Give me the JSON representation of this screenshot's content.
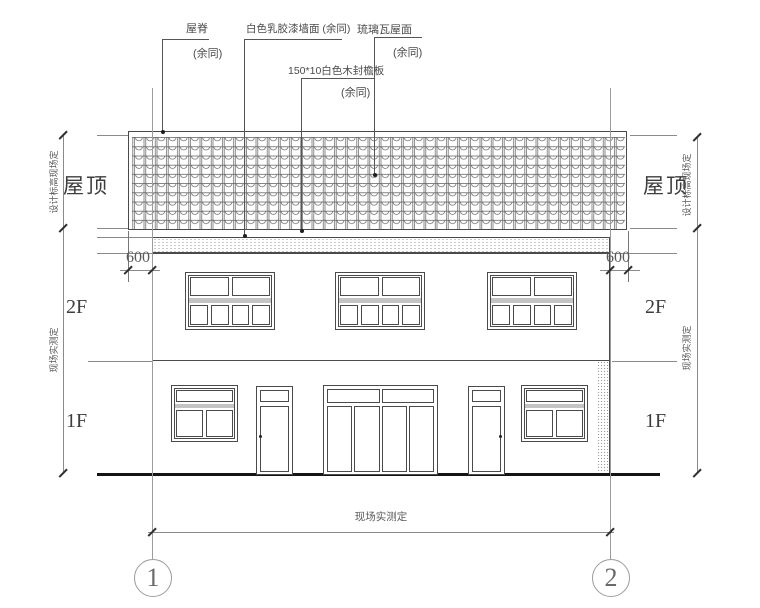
{
  "annotations": {
    "ridge": {
      "label": "屋脊",
      "note": "(余同)"
    },
    "wall_paint": {
      "label": "白色乳胶漆墙面 (余同)"
    },
    "glazed_tile": {
      "label": "琉璃瓦屋面",
      "note": "(余同)"
    },
    "fascia_board": {
      "label": "150*10白色木封檐板",
      "note": "(余同)"
    }
  },
  "levels": {
    "roof": {
      "left": "屋顶",
      "right": "屋顶"
    },
    "second_floor": {
      "left": "2F",
      "right": "2F"
    },
    "first_floor": {
      "left": "1F",
      "right": "1F"
    }
  },
  "dimensions": {
    "eave_overhang_left": "600",
    "eave_overhang_right": "600",
    "roof_height_left": "设计标高现场定",
    "roof_height_right": "设计标高现场定",
    "storey_height_left": "现场实测定",
    "storey_height_right": "现场实测定",
    "overall_width": "现场实测定"
  },
  "axes": {
    "axis_1": "1",
    "axis_2": "2"
  },
  "colors": {
    "line": "#4a4a4a",
    "dim_line": "#8a8a8a",
    "axis_line": "#9c9c9c",
    "ground": "#151515",
    "band_fill": "#c4c4c4"
  }
}
